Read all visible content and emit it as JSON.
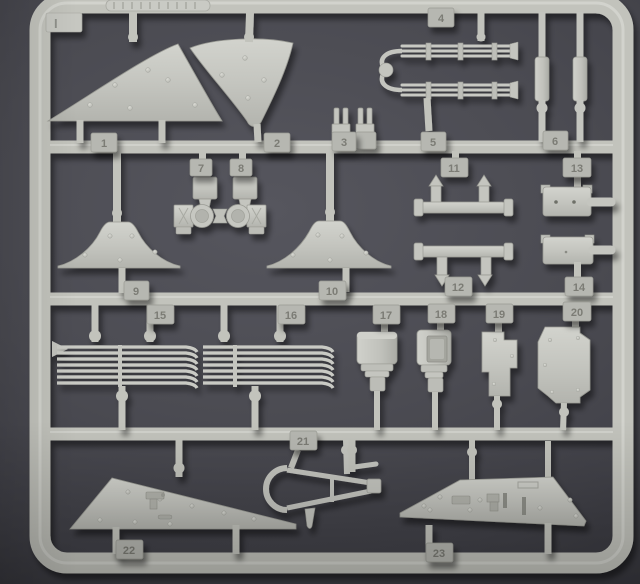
{
  "scene": {
    "description": "Photograph of a light grey injection-moulded model kit sprue (parts tree) lying on a dark grey surface",
    "background_color": "#47474d",
    "plastic_color": "#c2c3bc"
  },
  "sprue": {
    "corner_mark": "I",
    "tags": {
      "t1": "1",
      "t2": "2",
      "t3": "3",
      "t4": "4",
      "t5": "5",
      "t6": "6",
      "t7": "7",
      "t8": "8",
      "t9": "9",
      "t10": "10",
      "t11": "11",
      "t12": "12",
      "t13": "13",
      "t14": "14",
      "t15": "15",
      "t16": "16",
      "t17": "17",
      "t18": "18",
      "t19": "19",
      "t20": "20",
      "t21": "21",
      "t22": "22",
      "t23": "23"
    },
    "parts": [
      {
        "tag": "1",
        "name": "curved-fender-panel-left"
      },
      {
        "tag": "2",
        "name": "curved-fender-panel-right"
      },
      {
        "tag": "3",
        "name": "small-fork-brackets"
      },
      {
        "tag": "4",
        "name": "exhaust-pipe-manifold"
      },
      {
        "tag": "5",
        "name": "cylindrical-rod"
      },
      {
        "tag": "6",
        "name": "cylindrical-rod"
      },
      {
        "tag": "7",
        "name": "spring-hanger"
      },
      {
        "tag": "8",
        "name": "spring-hanger"
      },
      {
        "tag": "9",
        "name": "mudguard-profile"
      },
      {
        "tag": "10",
        "name": "mudguard-profile"
      },
      {
        "tag": "11",
        "name": "axle-rod-with-posts"
      },
      {
        "tag": "12",
        "name": "axle-rod-with-posts"
      },
      {
        "tag": "13",
        "name": "rectangular-box"
      },
      {
        "tag": "14",
        "name": "rectangular-box"
      },
      {
        "tag": "15",
        "name": "louvre-grille"
      },
      {
        "tag": "16",
        "name": "louvre-grille"
      },
      {
        "tag": "17",
        "name": "round-canister"
      },
      {
        "tag": "18",
        "name": "canister-with-recess"
      },
      {
        "tag": "19",
        "name": "notched-plate"
      },
      {
        "tag": "20",
        "name": "notched-plate-large"
      },
      {
        "tag": "21",
        "name": "towing-a-frame"
      },
      {
        "tag": "22",
        "name": "long-hull-side-panel"
      },
      {
        "tag": "23",
        "name": "long-hull-side-panel"
      }
    ]
  }
}
